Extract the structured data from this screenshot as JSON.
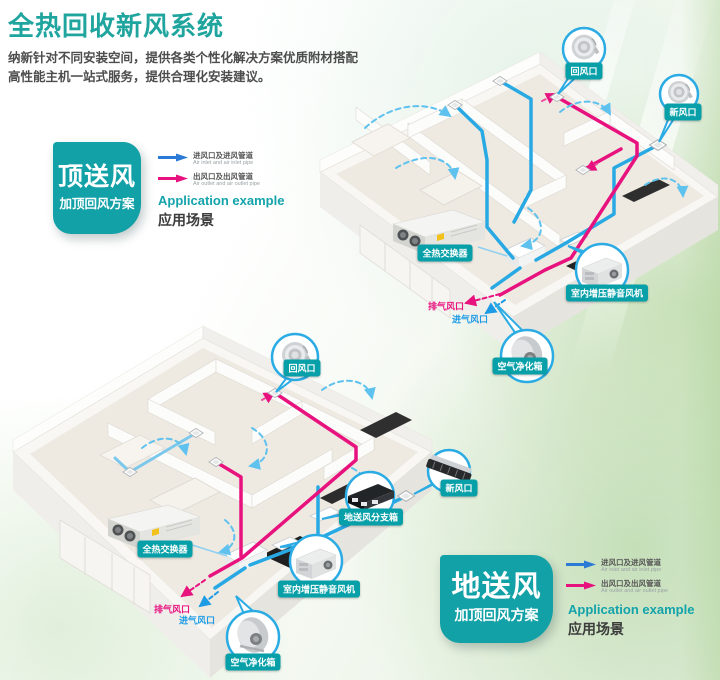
{
  "header": {
    "title": "全热回收新风系统",
    "desc_line1": "纳新针对不同安装空间，提供各类个性化解决方案优质附材搭配",
    "desc_line2": "高性能主机一站式服务，提供合理化安装建议。"
  },
  "legend": {
    "inlet_label": "进风口及进风管道",
    "inlet_label_en": "Air inlet and air inlet pipe",
    "outlet_label": "出风口及出风管道",
    "outlet_label_en": "Air outlet and air outlet pipe",
    "application_en": "Application example",
    "application_cn": "应用场景"
  },
  "scheme_top": {
    "name": "顶送风",
    "plan": "加顶回风方案"
  },
  "scheme_bottom": {
    "name": "地送风",
    "plan": "加顶回风方案"
  },
  "labels": {
    "return_vent": "回风口",
    "fresh_vent": "新风口",
    "heat_exchanger": "全热交换器",
    "booster_fan": "室内增压静音风机",
    "exhaust_port": "排气风口",
    "intake_port": "进气风口",
    "purifier": "空气净化箱",
    "floor_branch_box": "地送风分支箱"
  },
  "colors": {
    "accent_teal": "#12a1a7",
    "title_teal": "#1fa49e",
    "magenta": "#e8127f",
    "legend_blue": "#2b7bd6",
    "pipe_blue": "#29a9e3",
    "pipe_blue_light": "#5fc2ee",
    "text_dark": "#4d4d4d"
  }
}
